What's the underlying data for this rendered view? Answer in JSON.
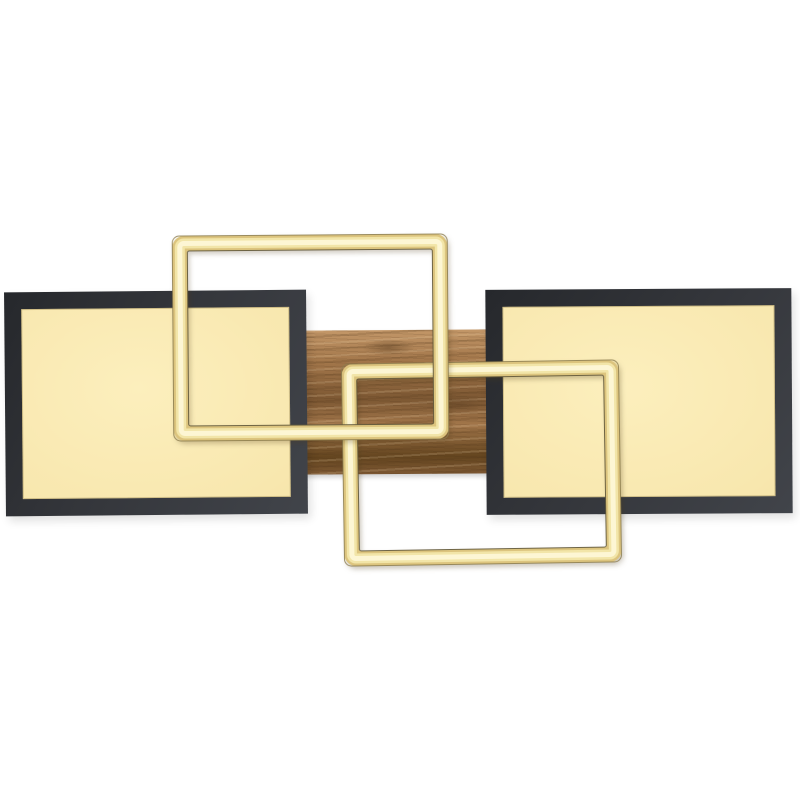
{
  "scene": {
    "type": "product-photo",
    "subject": "Modern LED ceiling light with interlocking rectangles",
    "description": "Product photo on a plain white background: a modern LED ceiling light composed of two black-framed rectangular panels glowing warm pale yellow, two interlocking open gold-brass LED rectangle frames (upper-left frame crossing in front of the lower-right frame), all joined by a horizontal wood-grain mounting plate visible in the middle.",
    "background_color": "#ffffff"
  },
  "objects": [
    {
      "name": "left-black-panel",
      "kind": "rectangular LED panel, matte black frame, warm-white illuminated face"
    },
    {
      "name": "right-black-panel",
      "kind": "rectangular LED panel, matte black frame, warm-white illuminated face"
    },
    {
      "name": "gold-led-frame-upper-left",
      "kind": "open rectangular illuminated brass/gold frame, overlaps left panel and wood plate, front-most"
    },
    {
      "name": "gold-led-frame-lower-right",
      "kind": "open rectangular illuminated brass/gold frame, overlaps right panel and wood plate"
    },
    {
      "name": "wood-mounting-plate",
      "kind": "horizontal oak wood-grain canopy bar behind the panels"
    }
  ],
  "colors": {
    "background": "#ffffff",
    "panel_frame_dark": "#26282c",
    "panel_frame_mid": "#34363b",
    "panel_frame_light": "#41444a",
    "panel_glow_center": "#fcefbd",
    "panel_glow_mid": "#f8e7ae",
    "panel_glow_edge": "#f0dc9e",
    "panel_glow_line": "rgba(150,130,75,0.40)",
    "led_frame_edge": "#dcc47e",
    "led_frame_mid": "#f2e5a8",
    "led_frame_core": "#fdf6d4",
    "led_frame_hairline_outer": "rgba(140,124,78,0.85)",
    "led_frame_hairline_inner": "rgba(96,88,58,0.90)",
    "wood_light": "#c39768",
    "wood_base": "#a2764a",
    "wood_dark": "#7d5833",
    "wood_deep": "#64451f"
  }
}
